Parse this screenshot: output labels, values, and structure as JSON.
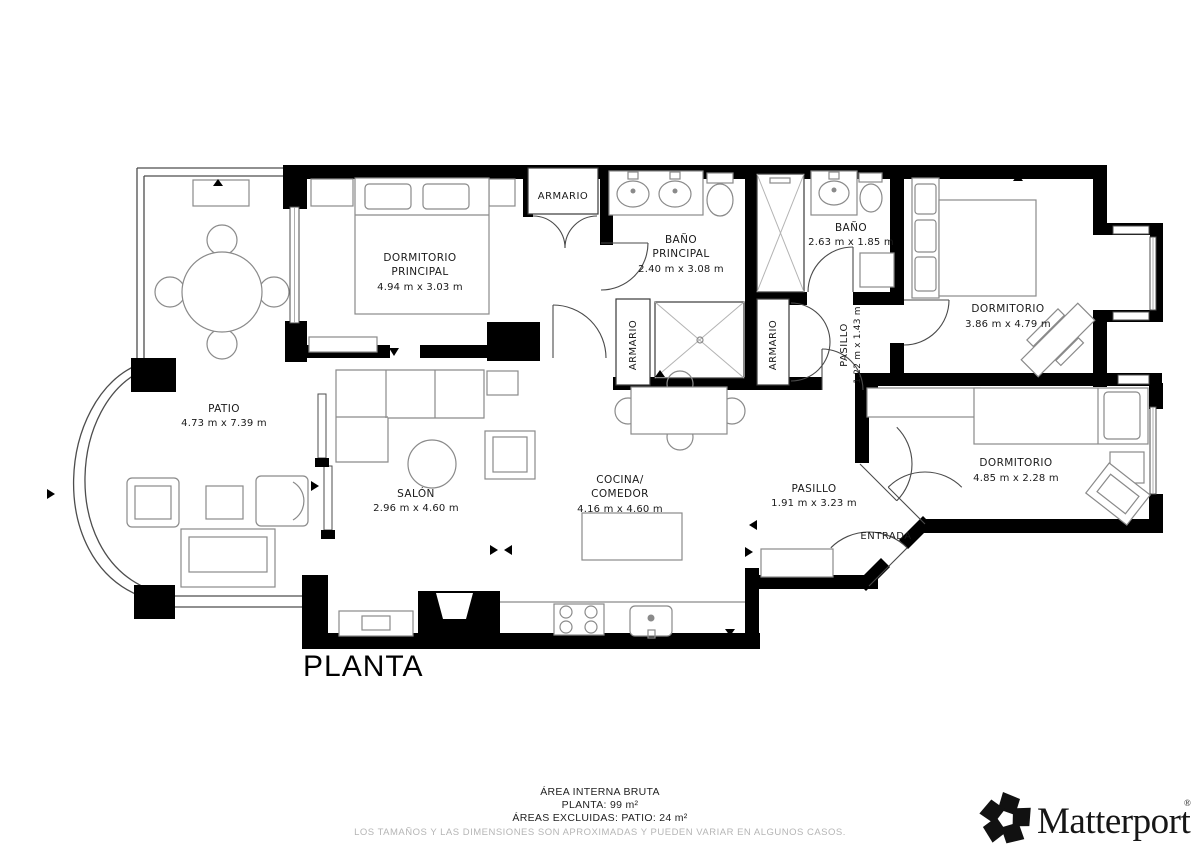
{
  "title": "PLANTA",
  "rooms": {
    "dormitorio_principal": {
      "line1": "DORMITORIO",
      "line2": "PRINCIPAL",
      "dims": "4.94 m x 3.03 m"
    },
    "bano_principal": {
      "line1": "BAÑO",
      "line2": "PRINCIPAL",
      "dims": "2.40 m x 3.08 m"
    },
    "bano": {
      "line1": "BAÑO",
      "dims": "2.63 m x 1.85 m"
    },
    "dormitorio_derecha": {
      "line1": "DORMITORIO",
      "dims": "3.86 m x 4.79 m"
    },
    "dormitorio_inferior": {
      "line1": "DORMITORIO",
      "dims": "4.85 m x 2.28 m"
    },
    "patio": {
      "line1": "PATIO",
      "dims": "4.73 m x 7.39 m"
    },
    "salon": {
      "line1": "SALÓN",
      "dims": "2.96 m x 4.60 m"
    },
    "cocina_comedor": {
      "line1": "COCINA/",
      "line2": "COMEDOR",
      "dims": "4.16 m x 4.60 m"
    },
    "pasillo": {
      "line1": "PASILLO",
      "dims": "1.91 m x 3.23 m"
    },
    "pasillo_pequeno": {
      "line1": "PASILLO",
      "dims": "1.22 m x 1.43 m"
    },
    "armario_superior": {
      "line1": "ARMARIO"
    },
    "armario_izquierdo": {
      "line1": "ARMARIO"
    },
    "armario_derecho": {
      "line1": "ARMARIO"
    },
    "entrada": {
      "line1": "ENTRADA"
    }
  },
  "footer": {
    "line1": "ÁREA INTERNA BRUTA",
    "line2": "PLANTA: 99 m²",
    "line3": "ÁREAS EXCLUIDAS: PATIO: 24 m²",
    "disclaimer": "LOS TAMAÑOS Y LAS DIMENSIONES SON APROXIMADAS Y PUEDEN VARIAR EN ALGUNOS CASOS."
  },
  "brand": {
    "name": "Matterport",
    "registered": "®"
  },
  "colors": {
    "wall": "#000000",
    "furniture": "#8a8a8a",
    "label": "#1a1a1a",
    "disclaimer": "#b5b5b5"
  }
}
